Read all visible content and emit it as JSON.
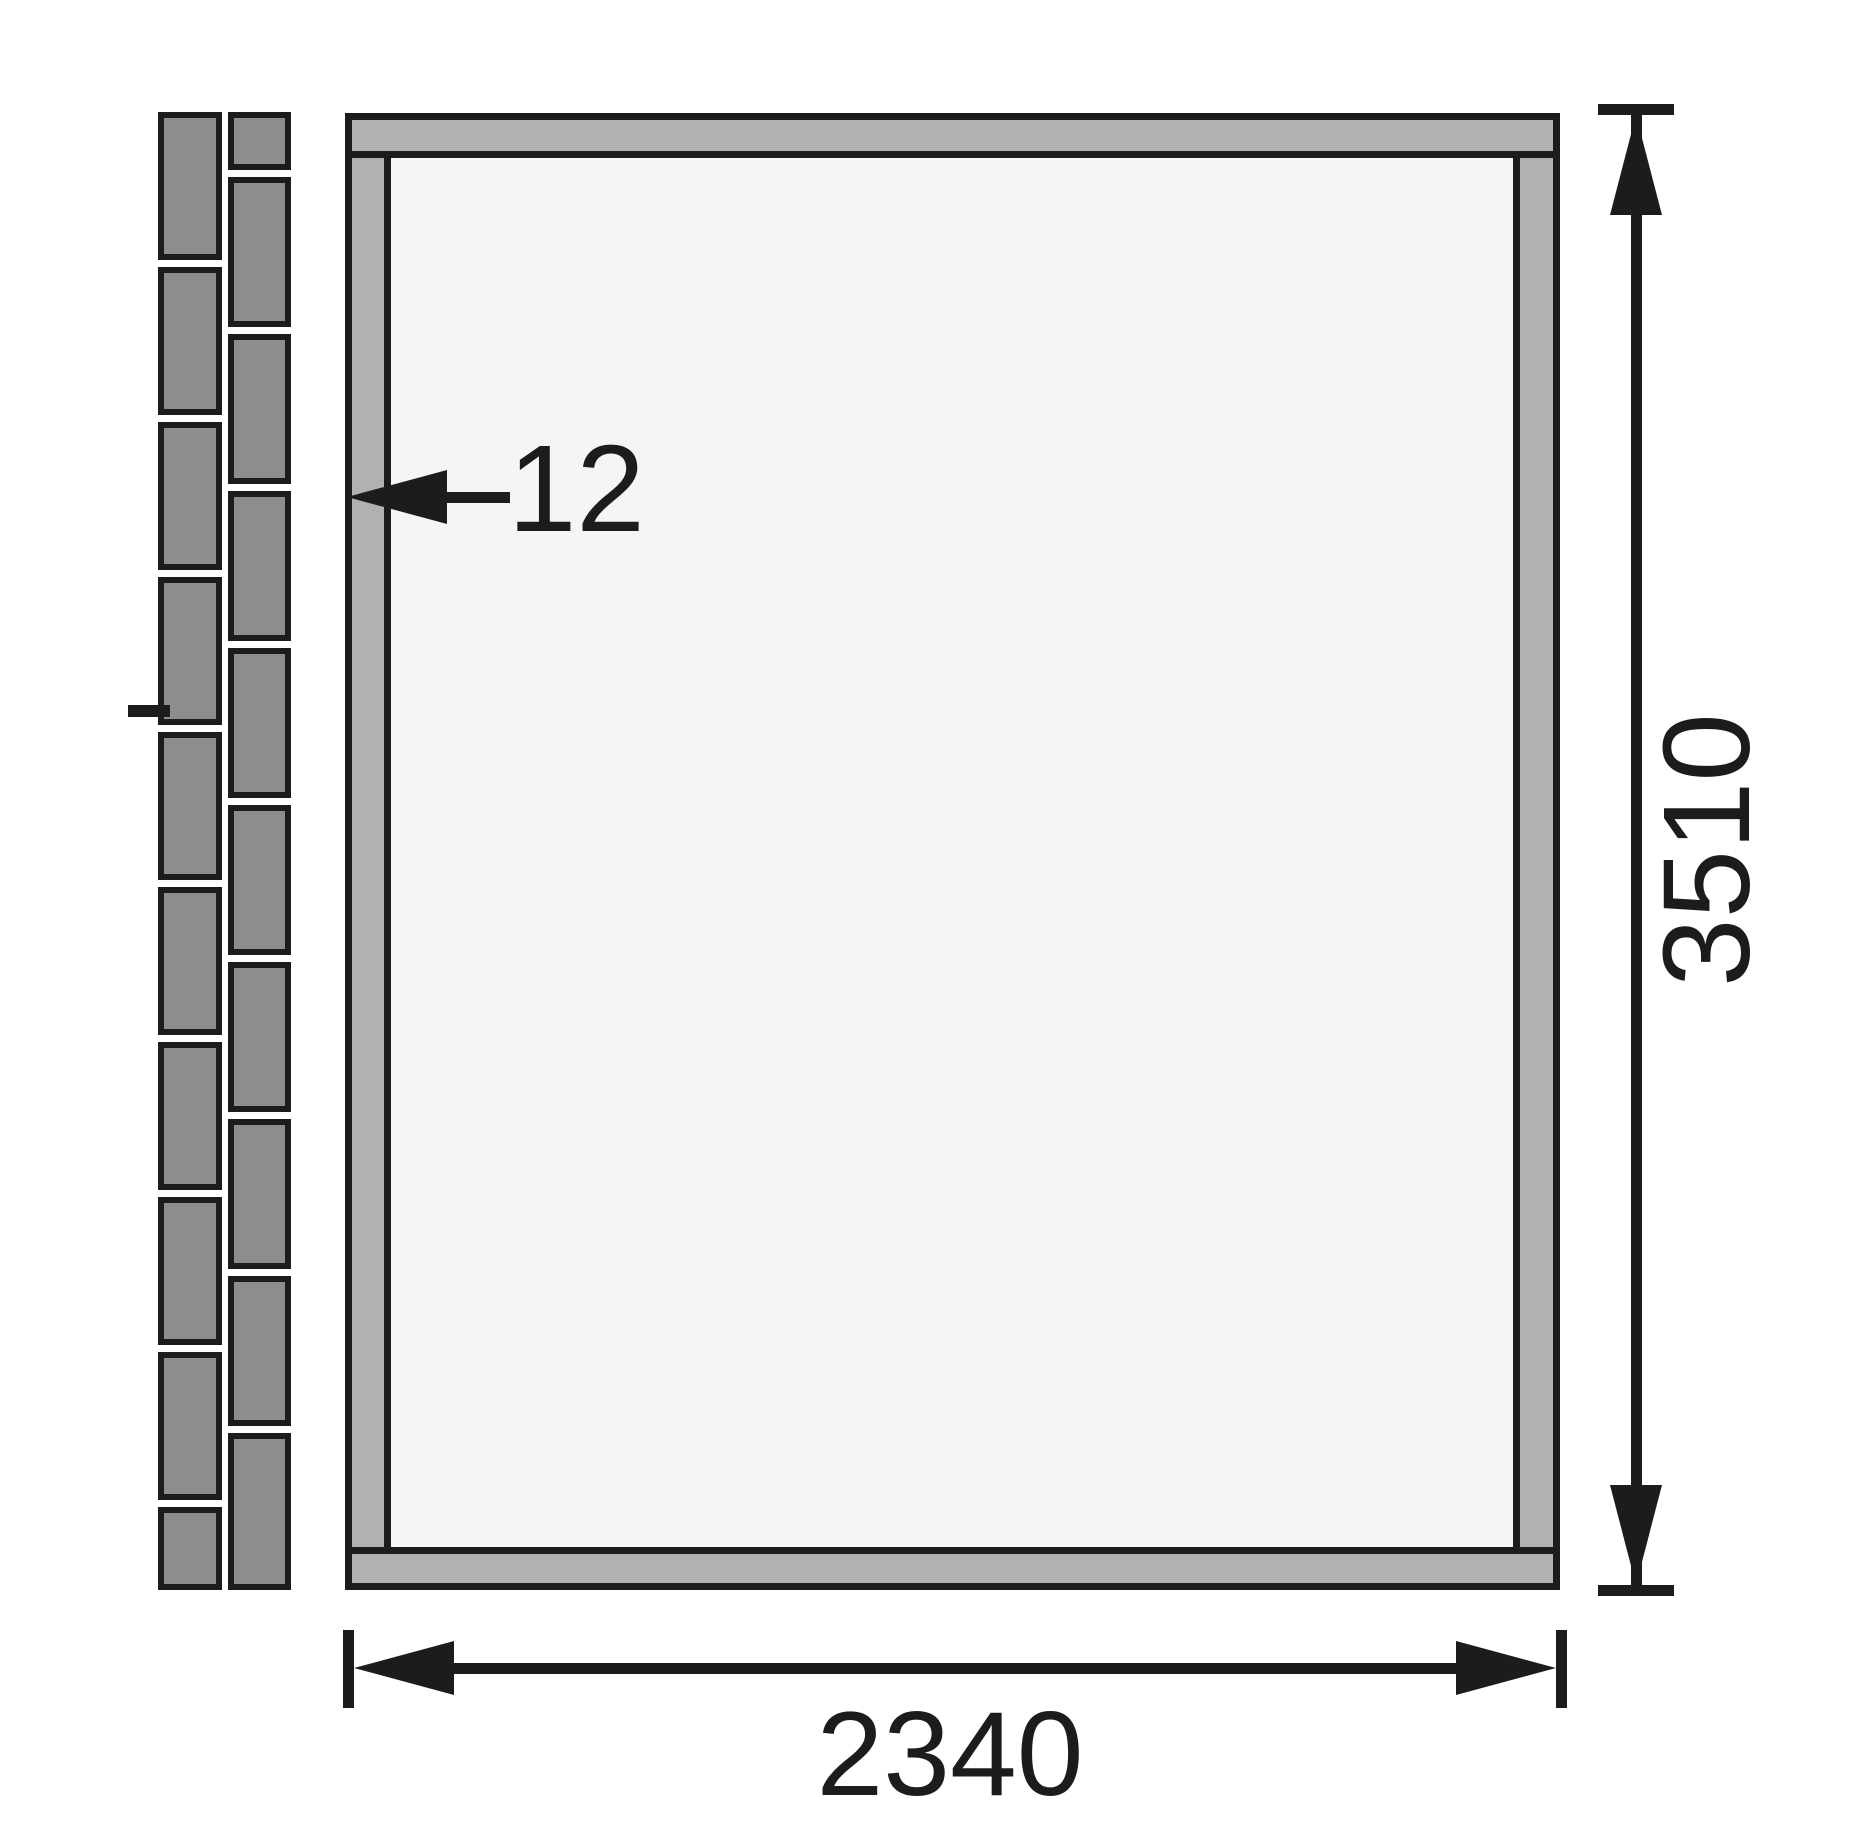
{
  "diagram": {
    "type": "floor-plan",
    "labels": {
      "wall_thickness": "12",
      "height": "3510",
      "width": "2340"
    },
    "colors": {
      "background": "#ffffff",
      "line": "#1c1c1c",
      "brick_fill": "#8d8d8f",
      "frame_fill": "#b1b1b3",
      "floor_fill": "#f5f5f6"
    },
    "brick_wall": {
      "gap": 7,
      "columns": [
        {
          "id": "outer",
          "bricks": [
            148,
            148,
            148,
            148,
            148,
            148,
            148,
            148,
            148,
            83
          ]
        },
        {
          "id": "inner",
          "bricks": [
            58,
            150,
            150,
            150,
            150,
            150,
            150,
            150,
            150,
            157
          ]
        }
      ]
    }
  }
}
